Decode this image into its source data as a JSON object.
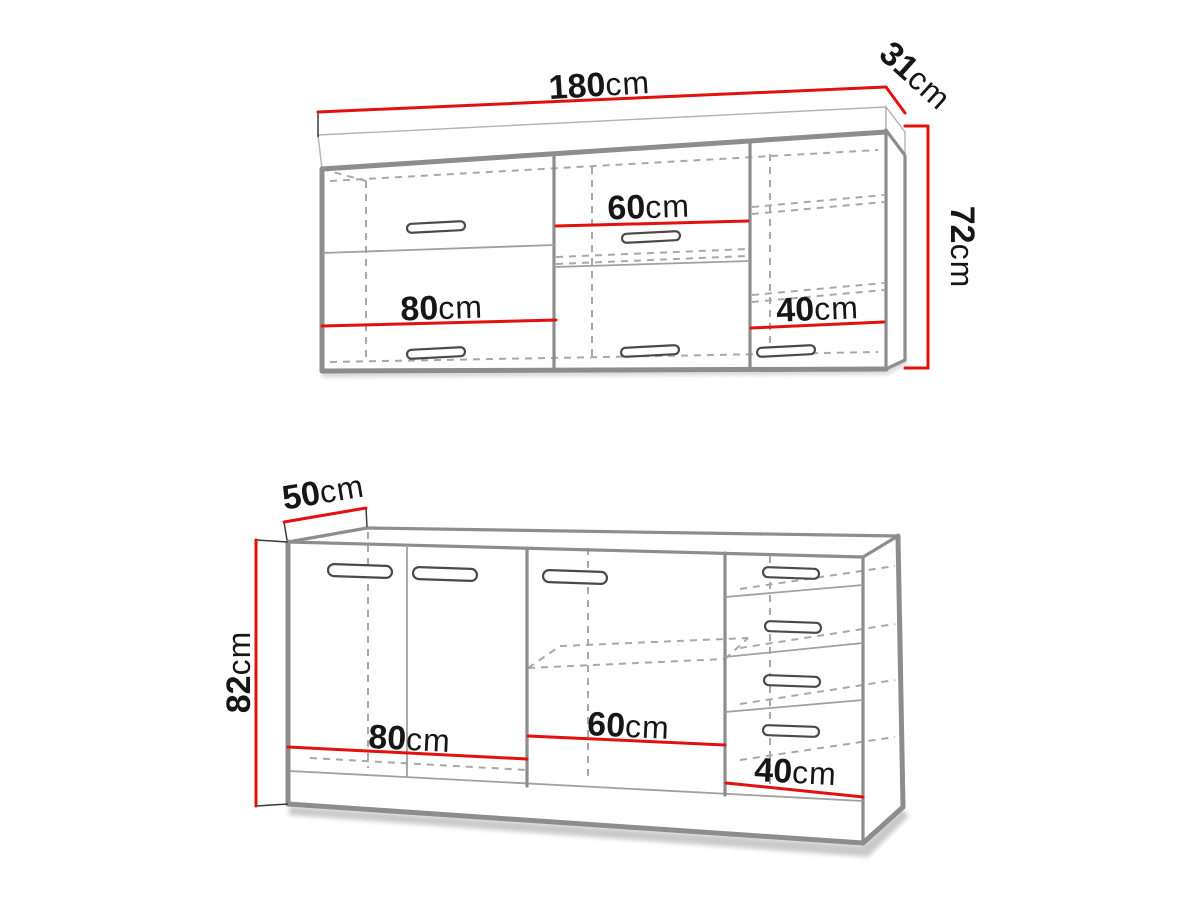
{
  "diagram_type": "kitchen-cabinet-set-dimensions",
  "background": "#ffffff",
  "colors": {
    "dimension_line": "#e31010",
    "outline_strong": "#8d8d8d",
    "outline_light": "#a9a9a9",
    "hidden_line": "#a8a8a8",
    "label_text": "#161616",
    "shadow": "#a5a5a5"
  },
  "upper": {
    "name": "wall cabinet",
    "width": {
      "value": "180",
      "unit": "cm"
    },
    "depth": {
      "value": "31",
      "unit": "cm"
    },
    "height": {
      "value": "72",
      "unit": "cm"
    },
    "sections": [
      {
        "value": "80",
        "unit": "cm"
      },
      {
        "value": "60",
        "unit": "cm"
      },
      {
        "value": "40",
        "unit": "cm"
      }
    ]
  },
  "lower": {
    "name": "base cabinet",
    "depth": {
      "value": "50",
      "unit": "cm"
    },
    "height": {
      "value": "82",
      "unit": "cm"
    },
    "sections": [
      {
        "value": "80",
        "unit": "cm"
      },
      {
        "value": "60",
        "unit": "cm"
      },
      {
        "value": "40",
        "unit": "cm"
      }
    ]
  }
}
